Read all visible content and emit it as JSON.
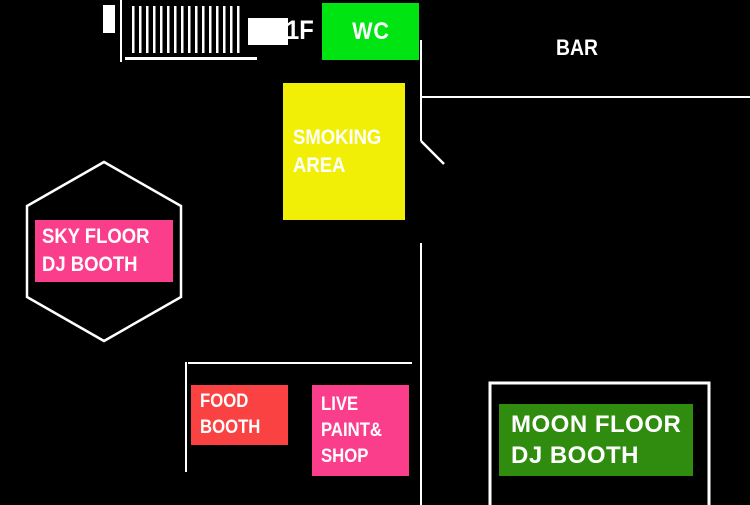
{
  "colors": {
    "background": "#000000",
    "wall": "#ffffff",
    "wc_green": "#00e412",
    "smoking_yellow": "#f2ef07",
    "pink": "#fb3e8c",
    "food_red": "#fb4242",
    "moon_green": "#2f8c0f",
    "label_text": "#ffffff"
  },
  "icons": {
    "stairs": "hatched-bars-icon",
    "door": "diagonal-swing-line"
  },
  "areas": {
    "stairs": {
      "floor_label": "1F"
    },
    "wc": {
      "label": "WC"
    },
    "bar": {
      "label": "BAR"
    },
    "smoking_area": {
      "lines": [
        "SMOKING",
        "AREA"
      ]
    },
    "sky_floor": {
      "lines": [
        "SKY FLOOR",
        "DJ BOOTH"
      ]
    },
    "food_booth": {
      "lines": [
        "FOOD",
        "BOOTH"
      ]
    },
    "live_paint_shop": {
      "lines": [
        "LIVE",
        "PAINT&",
        "SHOP"
      ]
    },
    "moon_floor": {
      "lines": [
        "MOON FLOOR",
        "DJ BOOTH"
      ]
    }
  }
}
